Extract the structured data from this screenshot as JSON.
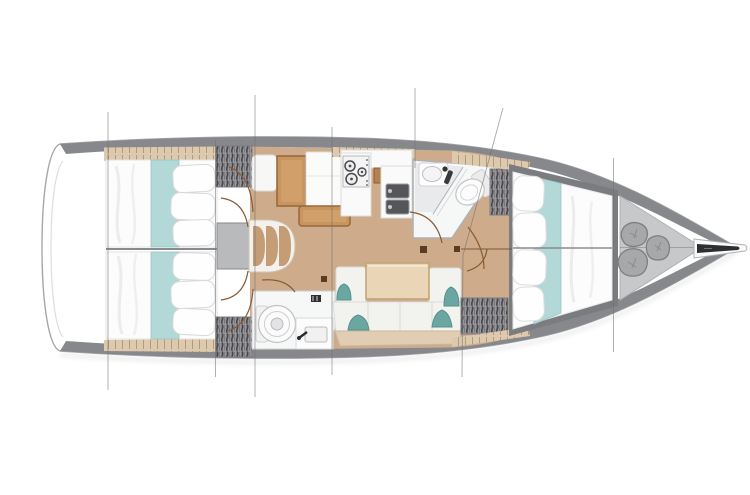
{
  "scene": {
    "kind": "sailboat-interior-floorplan",
    "orientation": "bow-right",
    "background": "#ffffff"
  },
  "palette": {
    "hull_band": "#87888b",
    "hull_outline": "#a6a7aa",
    "transom_inner_line": "#dedee0",
    "deck_white": "#ffffff",
    "floor_wood": "#cdab8b",
    "shelf_beige": "#dcc9ae",
    "shelf_tick": "#b49a76",
    "mattress_white": "#fcfcfd",
    "runner_teal": "#b2d8d8",
    "cushion_teal": "#6ba7a2",
    "locker_gray": "#96969a",
    "locker_hatch_dark": "#46464a",
    "furniture_wood": "#c8945f",
    "furniture_wood_light": "#d19f6a",
    "table_wood": "#ead6b6",
    "counter_white": "#fafafa",
    "sink_dark": "#54565a",
    "platform_gray": "#b9babc",
    "step_tan": "#c49d77",
    "sofa_white": "#f2f2ef",
    "sofa_base": "#e0cdb4",
    "head_white": "#f6f7f7",
    "shower_gray": "#e9eaec",
    "forepeak_gray": "#c7c8ca",
    "bag_gray": "#a7a8aa",
    "bag_edge": "#7e7f82",
    "bow_fitting_dark": "#2e2f31",
    "door_arc_brown": "#8a5a33",
    "section_line": "#6f6f73",
    "bed_frame_gray": "#7b7c7f",
    "divider_line": "#8a8b8e"
  },
  "regions": [
    {
      "id": "aft-cabin-port",
      "icon": "double-berth-icon"
    },
    {
      "id": "aft-cabin-starboard",
      "icon": "double-berth-icon"
    },
    {
      "id": "companionway-steps",
      "icon": "steps-icon",
      "step_count": 3
    },
    {
      "id": "nav-station",
      "icon": "chart-table-icon"
    },
    {
      "id": "galley",
      "icon": "stove-icon",
      "burner_count": 3,
      "sink_count": 2
    },
    {
      "id": "aft-head",
      "icon": "toilet-icon",
      "fixtures": [
        "toilet",
        "sink"
      ]
    },
    {
      "id": "salon",
      "icon": "table-icon",
      "teal_cushion_count": 4
    },
    {
      "id": "forward-head",
      "icon": "toilet-icon",
      "fixtures": [
        "toilet",
        "sink",
        "shower"
      ]
    },
    {
      "id": "forward-cabin",
      "icon": "double-berth-icon"
    },
    {
      "id": "forepeak",
      "icon": "sail-bag-icon",
      "bag_count": 3
    },
    {
      "id": "bow-fitting",
      "icon": "anchor-roller-icon"
    }
  ],
  "section_lines": {
    "count": 7
  }
}
